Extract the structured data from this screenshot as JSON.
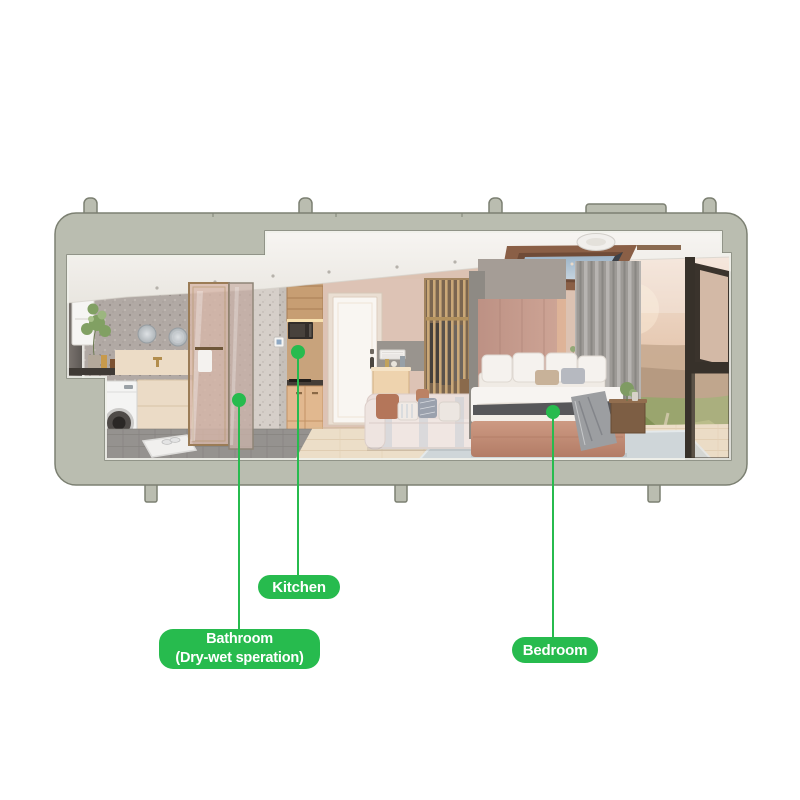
{
  "page": {
    "background_color": "#ffffff"
  },
  "figure": {
    "name": "modular-container-home-cutaway",
    "frame_color": "#babdb0",
    "frame_outline_color": "#7c8072",
    "scene_objects": [
      "ceiling-downlights",
      "skylight",
      "ceiling-lamp",
      "towel-panel",
      "plant",
      "bathroom-counter",
      "round-mirrors",
      "vanity-cabinet",
      "washing-machine",
      "shower-glass-door",
      "bath-mat-slippers",
      "terrazzo-column",
      "light-switch",
      "upper-kitchen-cabinet",
      "microwave",
      "lower-kitchen-cabinet",
      "entry-door",
      "door-handle",
      "wall-vent",
      "sideboard",
      "slatted-wardrobe",
      "sofa",
      "sofa-pillows",
      "headboard-wall",
      "bed-pillows",
      "bed",
      "bed-throw-blanket",
      "nightstand",
      "curtain",
      "window-view-mountains",
      "open-window-sash",
      "area-rug"
    ]
  },
  "callouts": {
    "accent_color": "#27bb4e",
    "text_color": "#ffffff",
    "items": [
      {
        "id": "kitchen",
        "lines": [
          "Kitchen"
        ]
      },
      {
        "id": "bathroom",
        "lines": [
          "Bathroom",
          "(Dry-wet speration)"
        ]
      },
      {
        "id": "bedroom",
        "lines": [
          "Bedroom"
        ]
      }
    ]
  }
}
